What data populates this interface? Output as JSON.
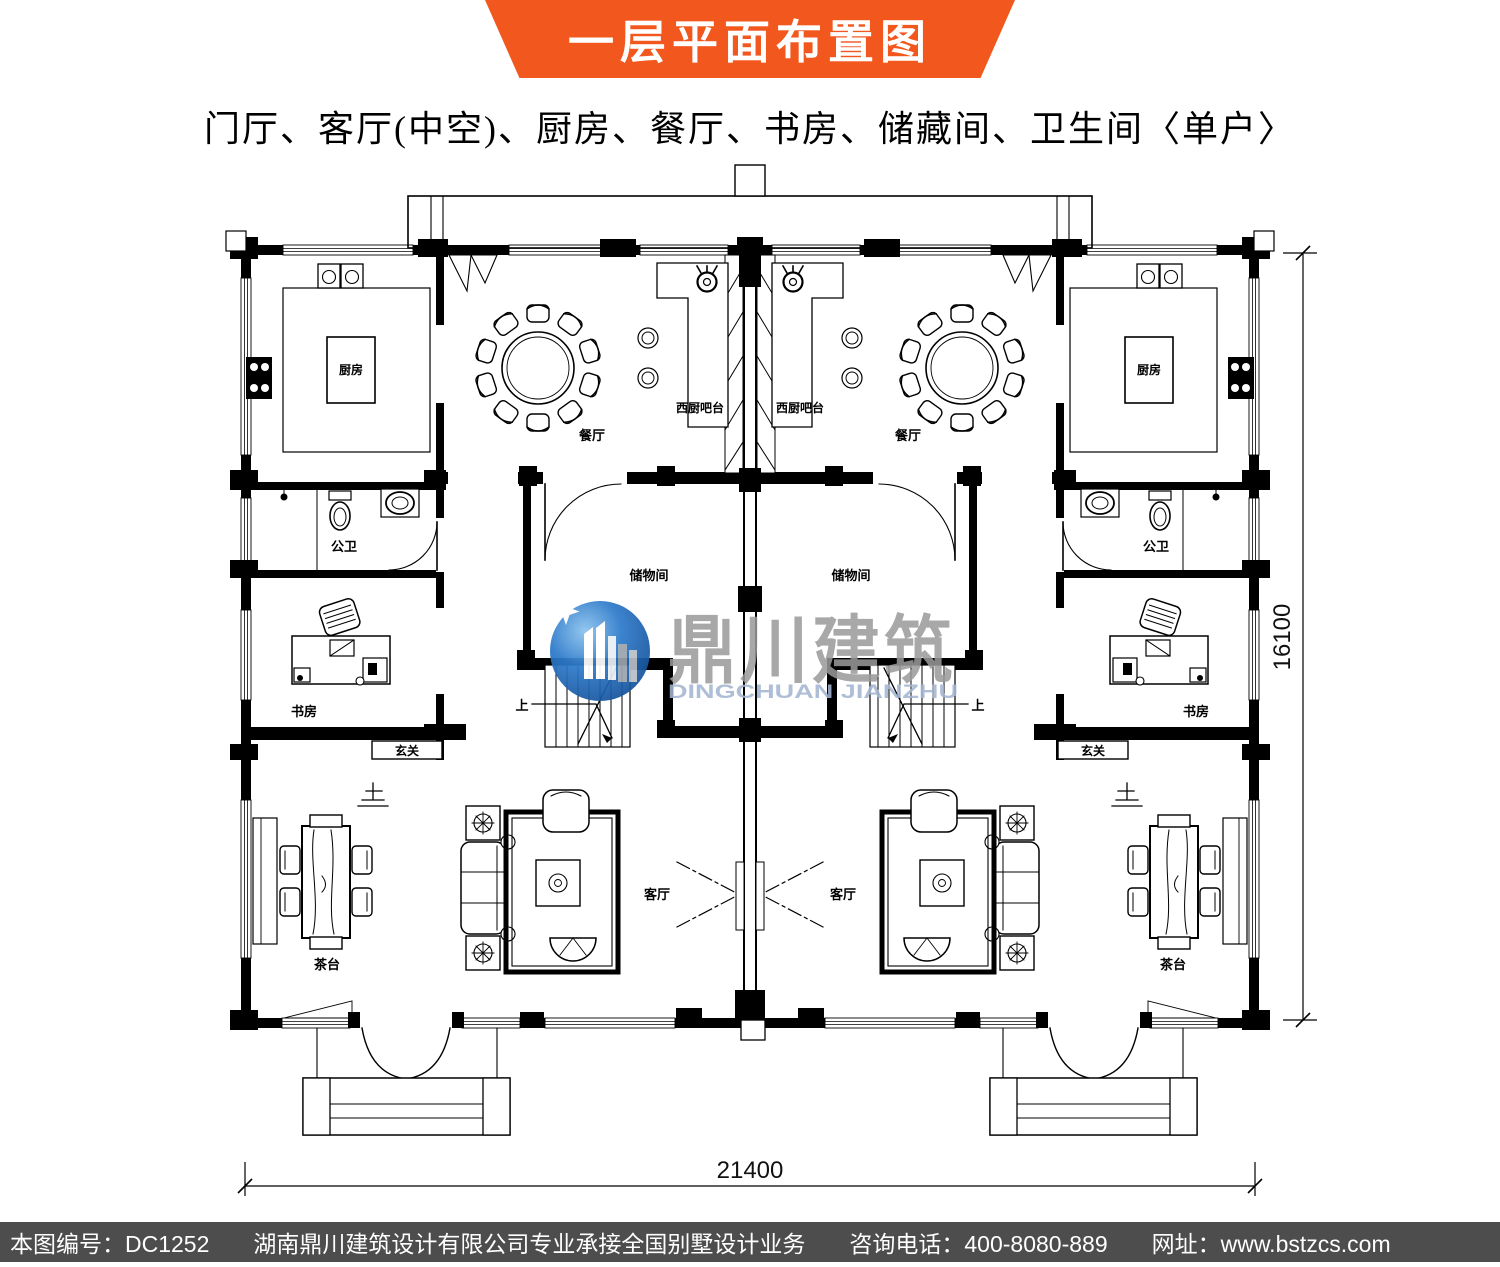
{
  "header": {
    "title": "一层平面布置图"
  },
  "subtitle": "门厅、客厅(中空)、厨房、餐厅、书房、储藏间、卫生间〈单户〉",
  "watermark": {
    "cn": "鼎川建筑",
    "en": "DINGCHUAN JIANZHU"
  },
  "labels": {
    "kitchen": "厨房",
    "dining": "餐厅",
    "bar": "西厨吧台",
    "bath": "公卫",
    "study": "书房",
    "foyer": "玄关",
    "storage": "储物间",
    "stairs_up": "上",
    "living": "客厅",
    "tea_table": "茶台"
  },
  "dimensions": {
    "bottom": "21400",
    "right": "16100"
  },
  "footer": {
    "drawing_no": "本图编号：DC1252",
    "company": "湖南鼎川建筑设计有限公司专业承接全国别墅设计业务",
    "phone": "咨询电话：400-8080-889",
    "website": "网址：www.bstzcs.com"
  },
  "colors": {
    "banner": "#F2571E",
    "footer_bg": "#4D4D4D",
    "logo_blue": "#1E6CC0",
    "watermark_gray": "#9B9B9B",
    "watermark_blue": "#A3B6D2"
  }
}
